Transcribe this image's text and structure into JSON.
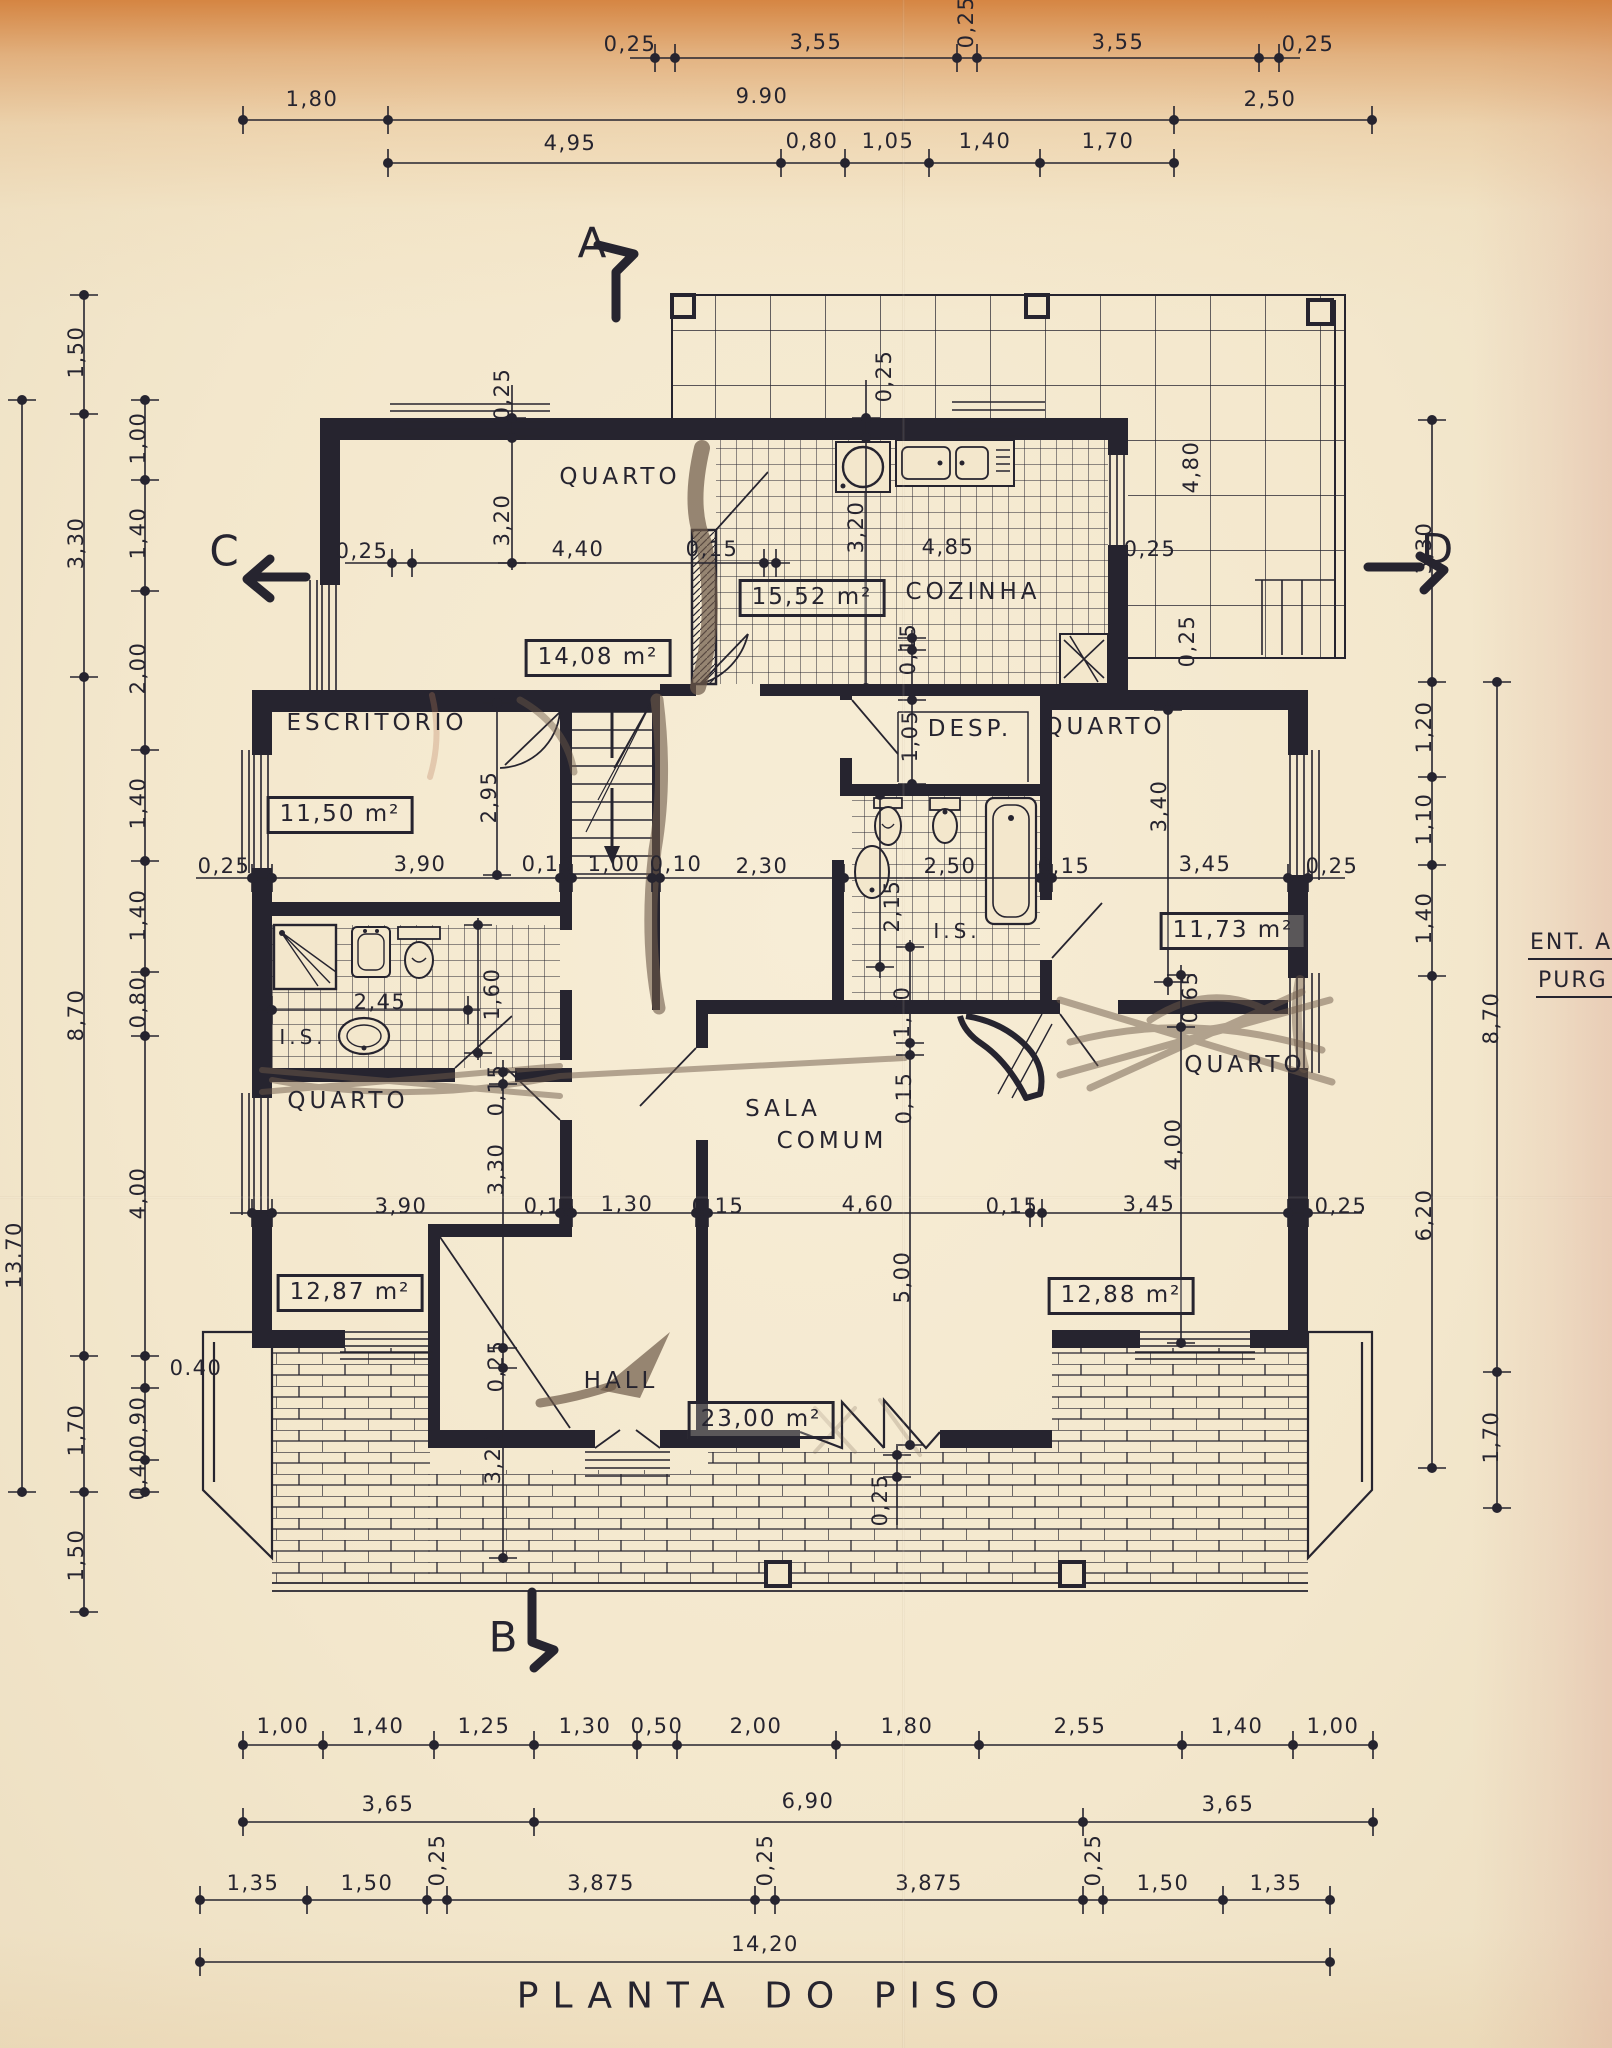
{
  "title": "PLANTA DO PISO",
  "colors": {
    "paper": "#f3e7cc",
    "paper_top_band": "#d17830",
    "ink": "#26242f",
    "pencil": "#6e5a49",
    "edge_pink": "#dba698"
  },
  "edge_labels": [
    {
      "t": "ENT. A",
      "x": 1528,
      "y": 945
    },
    {
      "t": "PURG",
      "x": 1536,
      "y": 983
    }
  ],
  "markers": [
    {
      "t": "A",
      "x": 592,
      "y": 243
    },
    {
      "t": "B",
      "x": 503,
      "y": 1637
    },
    {
      "t": "C",
      "x": 224,
      "y": 551
    },
    {
      "t": "D",
      "x": 1437,
      "y": 549
    }
  ],
  "rooms": [
    {
      "t": "QUARTO",
      "x": 620,
      "y": 477
    },
    {
      "t": "COZINHA",
      "x": 973,
      "y": 592
    },
    {
      "t": "ESCRITÓRIO",
      "x": 377,
      "y": 723
    },
    {
      "t": "DESP.",
      "x": 970,
      "y": 729
    },
    {
      "t": "QUARTO",
      "x": 1105,
      "y": 727
    },
    {
      "t": "QUARTO",
      "x": 348,
      "y": 1101
    },
    {
      "t": "SALA",
      "x": 783,
      "y": 1109
    },
    {
      "t": "COMUM",
      "x": 832,
      "y": 1141
    },
    {
      "t": "QUARTO",
      "x": 1245,
      "y": 1065
    },
    {
      "t": "HALL",
      "x": 621,
      "y": 1381
    },
    {
      "t": "I.S.",
      "x": 957,
      "y": 931,
      "fs": 20
    },
    {
      "t": "I.S.",
      "x": 303,
      "y": 1037,
      "fs": 20
    }
  ],
  "areas": [
    {
      "t": "14,08 m²",
      "x": 598,
      "y": 658
    },
    {
      "t": "15,52 m²",
      "x": 812,
      "y": 598
    },
    {
      "t": "11,50 m²",
      "x": 340,
      "y": 815
    },
    {
      "t": "11,73 m²",
      "x": 1233,
      "y": 931
    },
    {
      "t": "12,87 m²",
      "x": 350,
      "y": 1293
    },
    {
      "t": "23,00 m²",
      "x": 761,
      "y": 1420
    },
    {
      "t": "12,88 m²",
      "x": 1121,
      "y": 1296
    }
  ],
  "dims": [
    {
      "t": "0,25",
      "x": 630,
      "y": 44
    },
    {
      "t": "3,55",
      "x": 816,
      "y": 42
    },
    {
      "t": "0,25",
      "x": 966,
      "y": 22,
      "r": -90
    },
    {
      "t": "3,55",
      "x": 1118,
      "y": 42
    },
    {
      "t": "0,25",
      "x": 1308,
      "y": 44
    },
    {
      "t": "1,80",
      "x": 312,
      "y": 99
    },
    {
      "t": "9.90",
      "x": 762,
      "y": 96
    },
    {
      "t": "2,50",
      "x": 1270,
      "y": 99
    },
    {
      "t": "4,95",
      "x": 570,
      "y": 143
    },
    {
      "t": "0,80",
      "x": 812,
      "y": 141
    },
    {
      "t": "1,05",
      "x": 888,
      "y": 141
    },
    {
      "t": "1,40",
      "x": 985,
      "y": 141
    },
    {
      "t": "1,70",
      "x": 1108,
      "y": 141
    },
    {
      "t": "13.70",
      "x": 14,
      "y": 1255,
      "r": -90
    },
    {
      "t": "1,50",
      "x": 76,
      "y": 352,
      "r": -90
    },
    {
      "t": "3,30",
      "x": 76,
      "y": 543,
      "r": -90
    },
    {
      "t": "8,70",
      "x": 76,
      "y": 1015,
      "r": -90
    },
    {
      "t": "1,70",
      "x": 76,
      "y": 1430,
      "r": -90
    },
    {
      "t": "1,50",
      "x": 76,
      "y": 1555,
      "r": -90
    },
    {
      "t": "1,00",
      "x": 138,
      "y": 438,
      "r": -90
    },
    {
      "t": "1,40",
      "x": 138,
      "y": 533,
      "r": -90
    },
    {
      "t": "2,00",
      "x": 138,
      "y": 668,
      "r": -90
    },
    {
      "t": "1,40",
      "x": 138,
      "y": 803,
      "r": -90
    },
    {
      "t": "1,40",
      "x": 138,
      "y": 915,
      "r": -90
    },
    {
      "t": "0,80",
      "x": 138,
      "y": 1002,
      "r": -90
    },
    {
      "t": "4,00",
      "x": 138,
      "y": 1193,
      "r": -90
    },
    {
      "t": "0.40",
      "x": 196,
      "y": 1368
    },
    {
      "t": "0,90",
      "x": 138,
      "y": 1422,
      "r": -90
    },
    {
      "t": "0,40",
      "x": 138,
      "y": 1474,
      "r": -90
    },
    {
      "t": "3,30",
      "x": 1424,
      "y": 548,
      "r": -90
    },
    {
      "t": "1,20",
      "x": 1424,
      "y": 727,
      "r": -90
    },
    {
      "t": "1,10",
      "x": 1424,
      "y": 819,
      "r": -90
    },
    {
      "t": "1,40",
      "x": 1424,
      "y": 918,
      "r": -90
    },
    {
      "t": "6,20",
      "x": 1424,
      "y": 1215,
      "r": -90
    },
    {
      "t": "8,70",
      "x": 1491,
      "y": 1018,
      "r": -90
    },
    {
      "t": "1,70",
      "x": 1491,
      "y": 1437,
      "r": -90
    },
    {
      "t": "1,00",
      "x": 283,
      "y": 1726
    },
    {
      "t": "1,40",
      "x": 378,
      "y": 1726
    },
    {
      "t": "1,25",
      "x": 484,
      "y": 1726
    },
    {
      "t": "1,30",
      "x": 585,
      "y": 1726
    },
    {
      "t": "0,50",
      "x": 657,
      "y": 1726
    },
    {
      "t": "2,00",
      "x": 756,
      "y": 1726
    },
    {
      "t": "1,80",
      "x": 907,
      "y": 1726
    },
    {
      "t": "2,55",
      "x": 1080,
      "y": 1726
    },
    {
      "t": "1,40",
      "x": 1237,
      "y": 1726
    },
    {
      "t": "1,00",
      "x": 1333,
      "y": 1726
    },
    {
      "t": "3,65",
      "x": 388,
      "y": 1804
    },
    {
      "t": "6,90",
      "x": 808,
      "y": 1801
    },
    {
      "t": "3,65",
      "x": 1228,
      "y": 1804
    },
    {
      "t": "1,35",
      "x": 253,
      "y": 1883
    },
    {
      "t": "1,50",
      "x": 367,
      "y": 1883
    },
    {
      "t": "0,25",
      "x": 437,
      "y": 1860,
      "r": -90
    },
    {
      "t": "3,875",
      "x": 601,
      "y": 1883
    },
    {
      "t": "0,25",
      "x": 765,
      "y": 1860,
      "r": -90
    },
    {
      "t": "3,875",
      "x": 929,
      "y": 1883
    },
    {
      "t": "0,25",
      "x": 1093,
      "y": 1860,
      "r": -90
    },
    {
      "t": "1,50",
      "x": 1163,
      "y": 1883
    },
    {
      "t": "1,35",
      "x": 1276,
      "y": 1883
    },
    {
      "t": "14,20",
      "x": 765,
      "y": 1944
    },
    {
      "t": "0,25",
      "x": 502,
      "y": 394,
      "r": -90
    },
    {
      "t": "3,20",
      "x": 502,
      "y": 520,
      "r": -90
    },
    {
      "t": "0,25",
      "x": 362,
      "y": 551
    },
    {
      "t": "4,40",
      "x": 578,
      "y": 549
    },
    {
      "t": "0,15",
      "x": 712,
      "y": 549
    },
    {
      "t": "0,25",
      "x": 884,
      "y": 376,
      "r": -90
    },
    {
      "t": "3,20",
      "x": 856,
      "y": 527,
      "r": -90
    },
    {
      "t": "4,85",
      "x": 948,
      "y": 547
    },
    {
      "t": "0,25",
      "x": 1150,
      "y": 549
    },
    {
      "t": "4,80",
      "x": 1191,
      "y": 467,
      "r": -90
    },
    {
      "t": "0,25",
      "x": 1187,
      "y": 641,
      "r": -90
    },
    {
      "t": "0,15",
      "x": 908,
      "y": 649,
      "r": -90
    },
    {
      "t": "1,05",
      "x": 910,
      "y": 736,
      "r": -90
    },
    {
      "t": "2,95",
      "x": 489,
      "y": 797,
      "r": -90
    },
    {
      "t": "3,40",
      "x": 1159,
      "y": 806,
      "r": -90
    },
    {
      "t": "0,25",
      "x": 224,
      "y": 866
    },
    {
      "t": "3,90",
      "x": 420,
      "y": 864
    },
    {
      "t": "0,15",
      "x": 548,
      "y": 864
    },
    {
      "t": "1,00",
      "x": 614,
      "y": 864
    },
    {
      "t": "0,10",
      "x": 676,
      "y": 864
    },
    {
      "t": "2,30",
      "x": 762,
      "y": 866
    },
    {
      "t": "2,50",
      "x": 950,
      "y": 866
    },
    {
      "t": "0,15",
      "x": 1064,
      "y": 866
    },
    {
      "t": "3,45",
      "x": 1205,
      "y": 864
    },
    {
      "t": "0,25",
      "x": 1332,
      "y": 866
    },
    {
      "t": "2,15",
      "x": 892,
      "y": 906,
      "r": -90
    },
    {
      "t": "2,45",
      "x": 380,
      "y": 1002
    },
    {
      "t": "1,60",
      "x": 492,
      "y": 994,
      "r": -90
    },
    {
      "t": "1,20",
      "x": 902,
      "y": 1012,
      "r": -90
    },
    {
      "t": "0,65",
      "x": 1190,
      "y": 997,
      "r": -90
    },
    {
      "t": "0,15",
      "x": 904,
      "y": 1098,
      "r": -90
    },
    {
      "t": "0,15",
      "x": 496,
      "y": 1090,
      "r": -90
    },
    {
      "t": "3,90",
      "x": 401,
      "y": 1206
    },
    {
      "t": "0,15",
      "x": 550,
      "y": 1206
    },
    {
      "t": "1,30",
      "x": 627,
      "y": 1204
    },
    {
      "t": "0,15",
      "x": 718,
      "y": 1206
    },
    {
      "t": "4,60",
      "x": 868,
      "y": 1204
    },
    {
      "t": "0,15",
      "x": 1012,
      "y": 1206
    },
    {
      "t": "3,45",
      "x": 1149,
      "y": 1204
    },
    {
      "t": "0,25",
      "x": 1341,
      "y": 1206
    },
    {
      "t": "3,30",
      "x": 496,
      "y": 1169,
      "r": -90
    },
    {
      "t": "4,00",
      "x": 1173,
      "y": 1144,
      "r": -90
    },
    {
      "t": "5,00",
      "x": 902,
      "y": 1277,
      "r": -90
    },
    {
      "t": "0,25",
      "x": 496,
      "y": 1366,
      "r": -90
    },
    {
      "t": "3,20",
      "x": 493,
      "y": 1458,
      "r": -90
    },
    {
      "t": "0,25",
      "x": 880,
      "y": 1500,
      "r": -90
    }
  ],
  "chains": {
    "h": [
      {
        "y": 58,
        "x1": 630,
        "x2": 1300,
        "xs": [
          655,
          675,
          957,
          977,
          1259,
          1279
        ]
      },
      {
        "y": 120,
        "x1": 243,
        "x2": 1372,
        "xs": [
          243,
          388,
          1174,
          1372
        ]
      },
      {
        "y": 163,
        "x1": 388,
        "x2": 1174,
        "xs": [
          388,
          781,
          845,
          929,
          1040,
          1174
        ]
      },
      {
        "y": 563,
        "x1": 345,
        "x2": 790,
        "xs": [
          392,
          412,
          764,
          776
        ]
      },
      {
        "y": 878,
        "x1": 196,
        "x2": 1345,
        "xs": [
          252,
          272,
          560,
          572,
          652,
          660,
          844,
          1040,
          1052,
          1288,
          1308
        ]
      },
      {
        "y": 1010,
        "x1": 262,
        "x2": 480,
        "xs": [
          272,
          468
        ]
      },
      {
        "y": 1213,
        "x1": 230,
        "x2": 1362,
        "xs": [
          252,
          272,
          560,
          572,
          696,
          708,
          1030,
          1042,
          1288,
          1308
        ]
      },
      {
        "y": 1745,
        "x1": 243,
        "x2": 1373,
        "xs": [
          243,
          323,
          434,
          534,
          637,
          677,
          836,
          979,
          1182,
          1293,
          1373
        ]
      },
      {
        "y": 1822,
        "x1": 243,
        "x2": 1373,
        "xs": [
          243,
          534,
          1083,
          1373
        ]
      },
      {
        "y": 1900,
        "x1": 200,
        "x2": 1330,
        "xs": [
          200,
          307,
          427,
          447,
          755,
          775,
          1083,
          1103,
          1223,
          1330
        ]
      },
      {
        "y": 1962,
        "x1": 200,
        "x2": 1330,
        "xs": [
          200,
          1330
        ]
      }
    ],
    "v": [
      {
        "x": 22,
        "y1": 400,
        "y2": 1492,
        "ys": [
          400,
          1492
        ]
      },
      {
        "x": 84,
        "y1": 295,
        "y2": 1612,
        "ys": [
          295,
          414,
          677,
          1356,
          1492,
          1612
        ]
      },
      {
        "x": 145,
        "y1": 400,
        "y2": 1492,
        "ys": [
          400,
          480,
          591,
          750,
          861,
          972,
          1036,
          1356,
          1388,
          1460,
          1492
        ]
      },
      {
        "x": 1432,
        "y1": 420,
        "y2": 1468,
        "ys": [
          420,
          682,
          777,
          865,
          976,
          1468
        ]
      },
      {
        "x": 1497,
        "y1": 682,
        "y2": 1508,
        "ys": [
          682,
          1372,
          1508
        ]
      },
      {
        "x": 512,
        "y1": 385,
        "y2": 570,
        "ys": [
          418,
          438,
          563
        ]
      },
      {
        "x": 866,
        "y1": 380,
        "y2": 690,
        "ys": [
          418,
          438,
          688
        ]
      },
      {
        "x": 497,
        "y1": 700,
        "y2": 878,
        "ys": [
          703,
          875
        ]
      },
      {
        "x": 912,
        "y1": 630,
        "y2": 790,
        "ys": [
          638,
          650,
          700,
          784
        ]
      },
      {
        "x": 880,
        "y1": 790,
        "y2": 978,
        "ys": [
          795,
          967
        ]
      },
      {
        "x": 1168,
        "y1": 700,
        "y2": 995,
        "ys": [
          710,
          982
        ]
      },
      {
        "x": 1181,
        "y1": 965,
        "y2": 1348,
        "ys": [
          975,
          1027,
          1343
        ]
      },
      {
        "x": 478,
        "y1": 918,
        "y2": 1060,
        "ys": [
          925,
          1053
        ]
      },
      {
        "x": 910,
        "y1": 940,
        "y2": 1445,
        "ys": [
          947,
          1043,
          1055,
          1445
        ]
      },
      {
        "x": 503,
        "y1": 1060,
        "y2": 1562,
        "ys": [
          1072,
          1084,
          1348,
          1368,
          1558
        ]
      },
      {
        "x": 897,
        "y1": 1446,
        "y2": 1525,
        "ys": [
          1455,
          1477
        ]
      }
    ]
  }
}
